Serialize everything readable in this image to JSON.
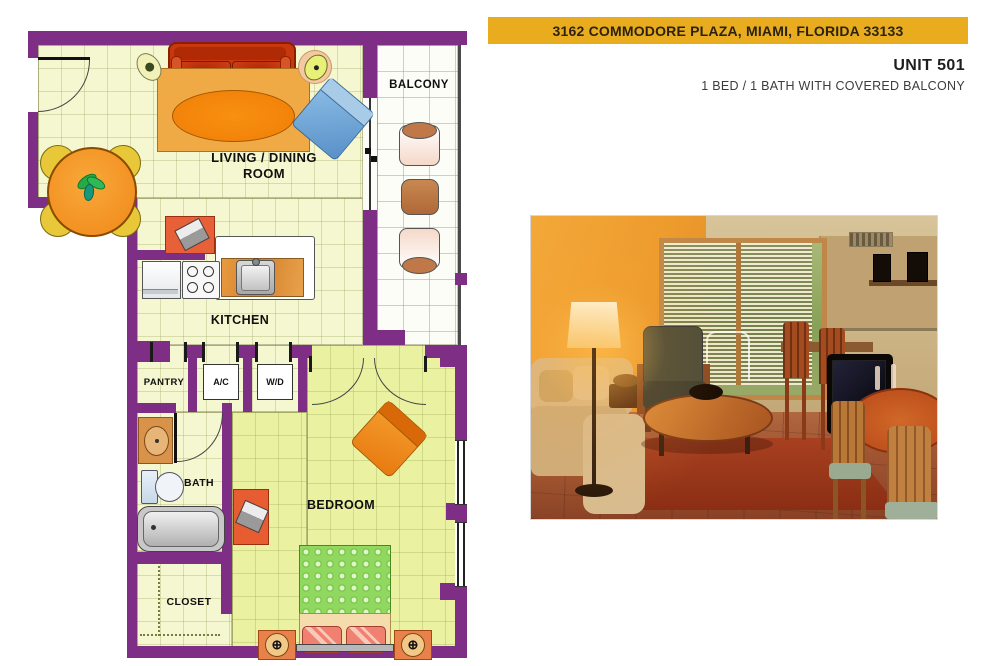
{
  "banner": {
    "address": "3162 COMMODORE PLAZA, MIAMI, FLORIDA 33133",
    "bg_color": "#E8AC1E"
  },
  "unit": {
    "title": "UNIT 501",
    "subtitle": "1 BED / 1 BATH WITH COVERED BALCONY"
  },
  "floorplan": {
    "labels": {
      "balcony": "BALCONY",
      "living_line1": "LIVING / DINING",
      "living_line2": "ROOM",
      "kitchen": "KITCHEN",
      "pantry": "PANTRY",
      "ac": "A/C",
      "wd": "W/D",
      "bath": "BATH",
      "closet": "CLOSET",
      "bedroom": "BEDROOM"
    },
    "colors": {
      "wall": "#7E2E85",
      "floor": "#F4F7D0",
      "bedroom_floor": "#EAF2A2",
      "balcony_floor": "#FDFDF8",
      "sofa": "#C8380F",
      "rug": "#F0AA45",
      "dining_table": "#F08818",
      "bed_blanket": "#90D860"
    },
    "nightstand_symbol": "⊕"
  }
}
